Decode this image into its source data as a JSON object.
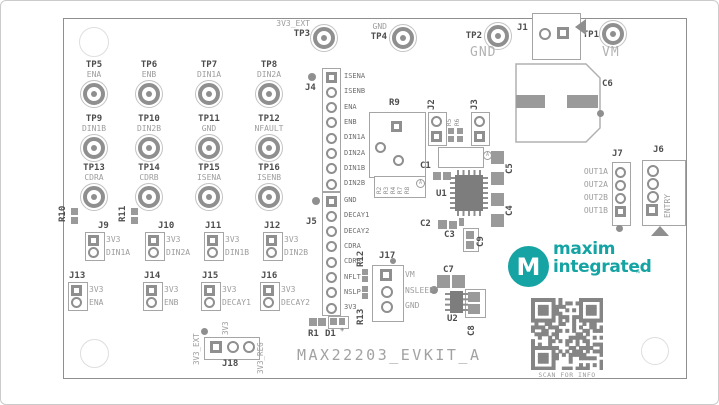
{
  "title": "MAX22203_EVKIT_A",
  "qr_caption": "SCAN FOR INFO",
  "logo": {
    "word1": "maxim",
    "word2": "integrated",
    "tm": "™",
    "monogram": "M"
  },
  "top_test_points": [
    {
      "ref": "TP3",
      "signal": "3V3_EXT"
    },
    {
      "ref": "TP4",
      "signal": "GND"
    },
    {
      "ref": "TP2",
      "signal": "GND"
    },
    {
      "ref": "TP1",
      "signal": "VM"
    }
  ],
  "test_points": [
    {
      "ref": "TP5",
      "signal": "ENA"
    },
    {
      "ref": "TP6",
      "signal": "ENB"
    },
    {
      "ref": "TP7",
      "signal": "DIN1A"
    },
    {
      "ref": "TP8",
      "signal": "DIN2A"
    },
    {
      "ref": "TP9",
      "signal": "DIN1B"
    },
    {
      "ref": "TP10",
      "signal": "DIN2B"
    },
    {
      "ref": "TP11",
      "signal": "GND"
    },
    {
      "ref": "TP12",
      "signal": "NFAULT"
    },
    {
      "ref": "TP13",
      "signal": "CDRA"
    },
    {
      "ref": "TP14",
      "signal": "CDRB"
    },
    {
      "ref": "TP15",
      "signal": "ISENA"
    },
    {
      "ref": "TP16",
      "signal": "ISENB"
    }
  ],
  "headers": {
    "j4": {
      "ref": "J4",
      "pins": [
        "ISENA",
        "ISENB",
        "ENA",
        "ENB",
        "DIN1A",
        "DIN2A",
        "DIN1B",
        "DIN2B"
      ]
    },
    "j5": {
      "ref": "J5",
      "pins": [
        "GND",
        "DECAY1",
        "DECAY2",
        "CDRA",
        "CDRB",
        "NFLT",
        "NSLP",
        "3V3"
      ]
    }
  },
  "jumpers": [
    {
      "ref": "J9",
      "top": "3V3",
      "bottom": "DIN1A"
    },
    {
      "ref": "J10",
      "top": "3V3",
      "bottom": "DIN2A"
    },
    {
      "ref": "J11",
      "top": "3V3",
      "bottom": "DIN1B"
    },
    {
      "ref": "J12",
      "top": "3V3",
      "bottom": "DIN2B"
    },
    {
      "ref": "J13",
      "top": "3V3",
      "bottom": "ENA"
    },
    {
      "ref": "J14",
      "top": "3V3",
      "bottom": "ENB"
    },
    {
      "ref": "J15",
      "top": "3V3",
      "bottom": "DECAY1"
    },
    {
      "ref": "J16",
      "top": "3V3",
      "bottom": "DECAY2"
    }
  ],
  "j17": {
    "ref": "J17",
    "pins": [
      "VM",
      "NSLEEP",
      "GND"
    ]
  },
  "j18": {
    "ref": "J18",
    "rails": [
      "3V3_EXT",
      "3V3",
      "3V3_REG"
    ]
  },
  "j7": {
    "ref": "J7",
    "pins": [
      "OUT1A",
      "OUT2A",
      "OUT2B",
      "OUT1B"
    ]
  },
  "j6": {
    "ref": "J6",
    "label": "ENTRY"
  },
  "j1": {
    "ref": "J1"
  },
  "j2": {
    "ref": "J2"
  },
  "j3": {
    "ref": "J3"
  },
  "parts": {
    "r1": "R1",
    "d1": "D1",
    "d1_mark": "+",
    "r5": "R5",
    "r6": "R6",
    "r9": "R9",
    "r10": "R10",
    "r11": "R11",
    "r12": "R12",
    "r13": "R13",
    "u1": "U1",
    "u2": "U2",
    "c1": "C1",
    "c2": "C2",
    "c3": "C3",
    "c4": "C4",
    "c5": "C5",
    "c6": "C6",
    "c7": "C7",
    "c8": "C8",
    "c9": "C9",
    "array_refs": [
      "R2",
      "R3",
      "R4",
      "R7",
      "R8"
    ],
    "a_marker": "A"
  }
}
